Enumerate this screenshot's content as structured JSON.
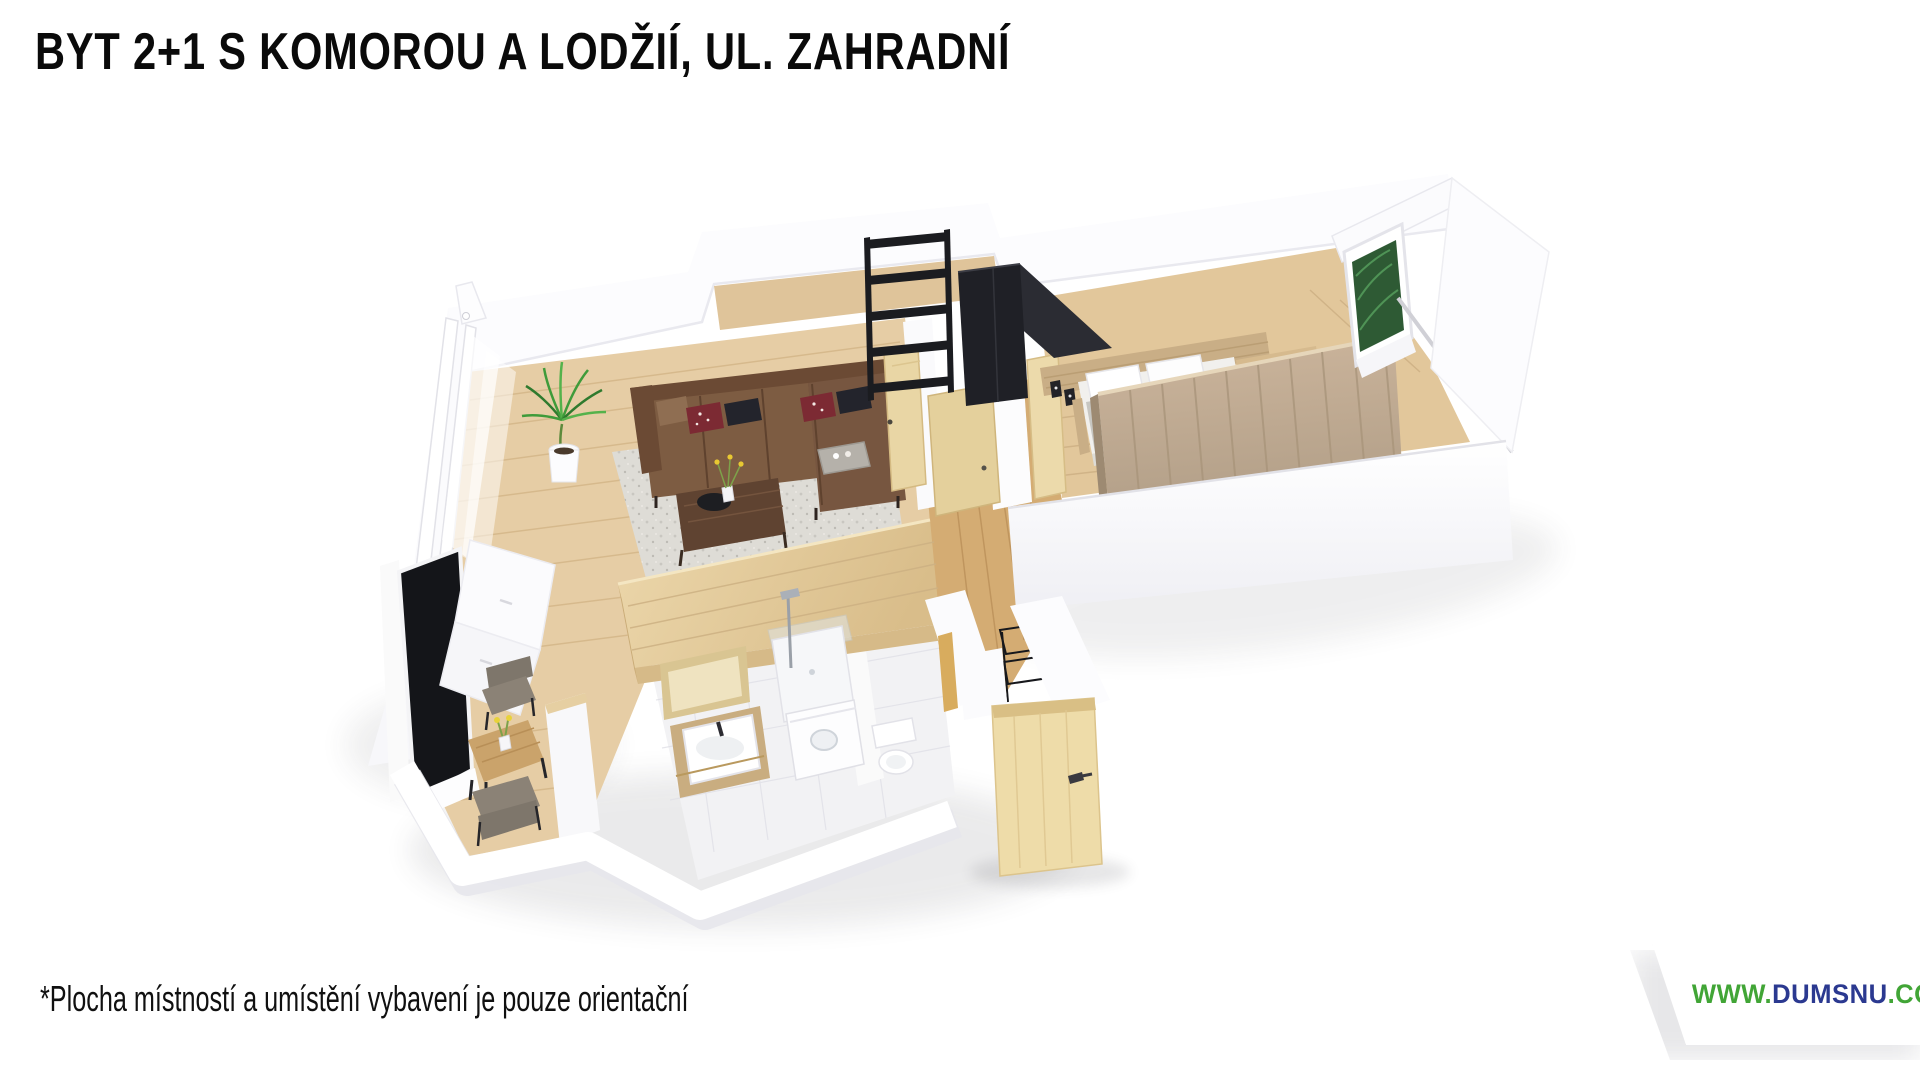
{
  "header": {
    "title": "BYT 2+1 S KOMOROU A LODŽIÍ, UL. ZAHRADNÍ"
  },
  "footer": {
    "disclaimer": "*Plocha místností a umístění vybavení je pouze orientační"
  },
  "watermark": {
    "www": "WWW.",
    "domain": "DUMSNU",
    "tld": ".COM",
    "color_green": "#41a536",
    "color_navy": "#2b3990",
    "badge_bg": "#ffffff"
  },
  "floorplan": {
    "type": "3d-isometric-apartment-render",
    "rooms": [
      {
        "name": "living-room-with-kitchenette",
        "furniture": [
          "corner-sofa-brown-leather",
          "decorative-pillows",
          "coffee-table-walnut",
          "vase-yellow-flowers",
          "shag-rug",
          "potted-plant",
          "kitchen-counter-white",
          "kitchen-island-wood",
          "dining-table",
          "dining-chairs-2",
          "window-wall-curtains",
          "dark-glass-panel"
        ]
      },
      {
        "name": "storage-room-komora",
        "furniture": [
          "black-shelving-unit",
          "black-wardrobe"
        ]
      },
      {
        "name": "bedroom",
        "furniture": [
          "double-bed",
          "white-pillows",
          "grey-bedspread",
          "wood-headboard-panel",
          "large-wardrobe",
          "nightstand-shelf",
          "picture-frames",
          "window-with-plants-view"
        ]
      },
      {
        "name": "bathroom",
        "furniture": [
          "vanity-with-sink",
          "leaning-mirror",
          "shower",
          "washing-machine",
          "toilet",
          "white-tiles"
        ]
      },
      {
        "name": "hallway",
        "furniture": [
          "entrance-door-open",
          "black-shoe-rack",
          "coat-on-hooks",
          "interior-doors-open"
        ]
      },
      {
        "name": "loggia",
        "furniture": [
          "white-railing-wall"
        ]
      }
    ],
    "palette": {
      "wall": "#ffffff",
      "floor_wood_light": "#e6cda5",
      "floor_wood_hall": "#d4ac73",
      "sofa_brown": "#7d5c42",
      "table_walnut": "#5f4331",
      "door_wood": "#eedca9",
      "black_furniture": "#1c1d21",
      "plant_green": "#3f9b3a",
      "rug_grey": "#dedcd6",
      "wardrobe_wood": "#c0ab92",
      "tile_white": "#f2f2f4"
    }
  }
}
